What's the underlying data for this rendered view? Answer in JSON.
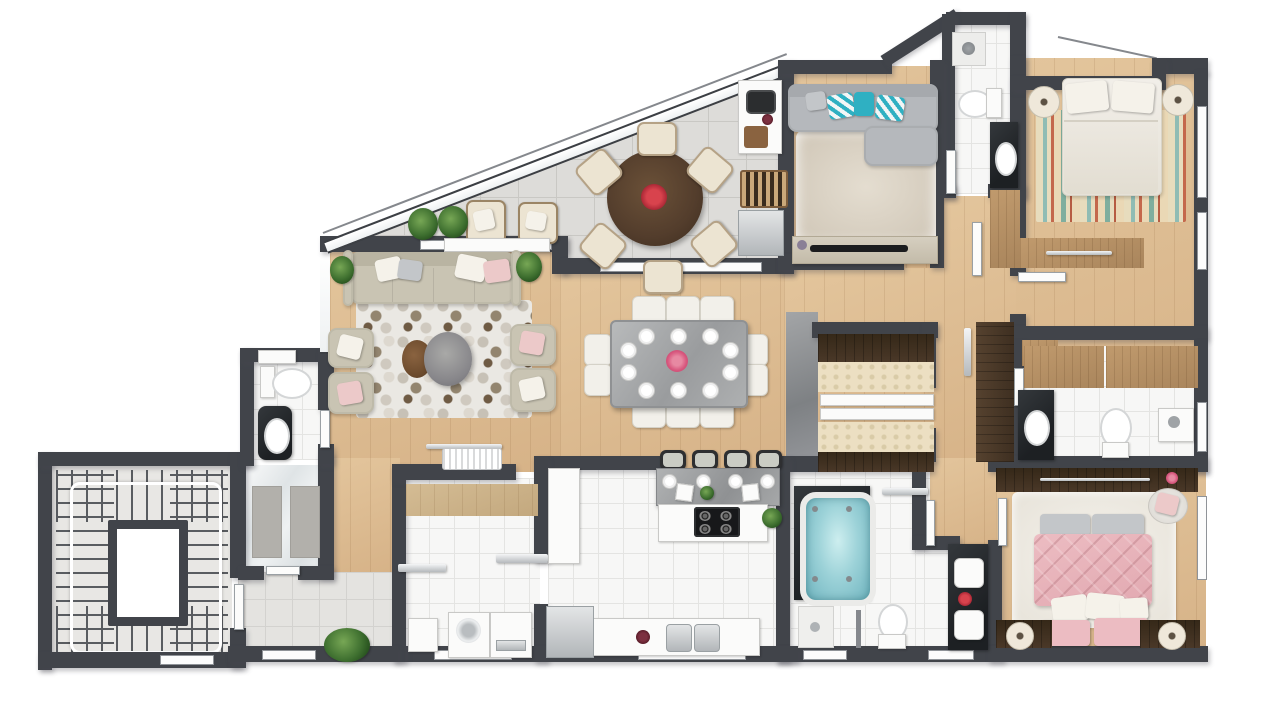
{
  "title": "apartment-floor-plan-3d-top-view",
  "canvas": {
    "width": 1280,
    "height": 725
  },
  "palette": {
    "wall": "#41444a",
    "sofaBeige": "#c9c4b3",
    "graySofa": "#b5b8bc",
    "teal": "#2fb0c2",
    "pinkPillow": "#ecc9c9",
    "pinkBed": "#ecbcc2",
    "jacuzzi": "#9cd2d8",
    "blackStone": "#1d2023",
    "woodFloor": "#d9b88d",
    "terraceTile": "#dddcd9",
    "whiteTile": "#f7f7f6"
  },
  "rooms": [
    {
      "name": "stairwell",
      "items": [
        "wrap-around-staircase",
        "elevator-shaft",
        "handrail"
      ]
    },
    {
      "name": "service-corridor",
      "items": [
        "window",
        "planter-bush"
      ]
    },
    {
      "name": "marble-shower-room",
      "items": [
        "marble-floor",
        "two-gray-mats"
      ]
    },
    {
      "name": "powder-room",
      "items": [
        "toilet",
        "black-stone-vanity-with-sink",
        "towel-shelf"
      ]
    },
    {
      "name": "laundry-room",
      "items": [
        "wood-counter",
        "washing-machine",
        "dryer",
        "water-heater"
      ]
    },
    {
      "name": "kitchen",
      "items": [
        "breakfast-bar",
        "island-with-gas-cooktop",
        "double-sink-counter",
        "refrigerator",
        "tall-cabinet",
        "plants"
      ]
    },
    {
      "name": "dining-area",
      "items": [
        "stone-dining-table",
        "white-chairs",
        "place-settings",
        "pink-flower-centerpiece"
      ]
    },
    {
      "name": "living-room",
      "items": [
        "beige-sofa",
        "four-armchairs",
        "hexagon-mosaic-rug",
        "two-round-coffee-tables",
        "two-plants",
        "console-with-ac-unit"
      ]
    },
    {
      "name": "terrace",
      "items": [
        "round-wood-dining-table",
        "six-cream-chairs",
        "red-flower-centerpiece",
        "two-outdoor-armchairs",
        "two-bushes",
        "white-planter",
        "glass-facade"
      ]
    },
    {
      "name": "barbecue-area",
      "items": [
        "counter-with-sink",
        "cutting-board",
        "charcoal-grill-with-logs",
        "steel-cabinet"
      ]
    },
    {
      "name": "tv-room",
      "items": [
        "l-shaped-gray-sofa",
        "teal-chevron-pillows",
        "shag-rug",
        "tv-console",
        "flat-tv"
      ]
    },
    {
      "name": "hall-bathroom",
      "items": [
        "shower",
        "toilet",
        "black-stone-vanity-with-sink",
        "door"
      ]
    },
    {
      "name": "bedroom-1",
      "items": [
        "double-bed-white",
        "striped-multicolor-rug",
        "two-round-nightstands-with-lamps",
        "wood-dresser",
        "wardrobe",
        "windows"
      ]
    },
    {
      "name": "walk-in-closet",
      "items": [
        "dark-wardrobe-units",
        "fabric-panels",
        "white-rails",
        "marble-feature-wall"
      ]
    },
    {
      "name": "ensuite-bathroom",
      "items": [
        "wood-wall-cabinets",
        "black-stone-vanity-with-sink",
        "toilet",
        "shower-panel",
        "tall-dark-wardrobe",
        "towel-rail"
      ]
    },
    {
      "name": "master-bedroom",
      "items": [
        "pink-quilted-bed",
        "white-shag-rug",
        "gray-foot-bench",
        "two-nightstands-with-lamps",
        "long-dark-dresser-with-flower",
        "round-stool-with-pink-towel",
        "window"
      ]
    },
    {
      "name": "master-bathroom",
      "items": [
        "spa-jacuzzi-on-black-platform",
        "double-black-stone-vanity",
        "red-flower",
        "toilet",
        "shower-corner",
        "glass-divider",
        "towel-rail",
        "windows"
      ]
    }
  ],
  "counts": {
    "dining_chairs": 10,
    "terrace_chairs": 6,
    "bar_stools": 4,
    "beds": 2,
    "armchairs": 4
  }
}
